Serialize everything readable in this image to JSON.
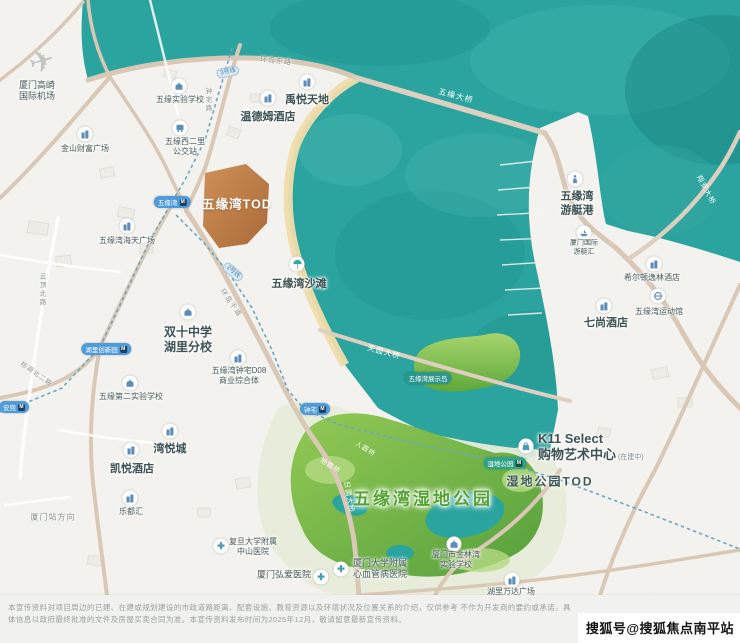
{
  "map": {
    "colors": {
      "water": "#2ba39e",
      "land": "#f3f2ee",
      "road": "#d9c8b5",
      "tod_fill": "#c8834f",
      "wetland_green": "#79bb45",
      "beach": "#f0dcab",
      "metro_dash": "#6aa7c8",
      "station_blue": "#4f9bd8",
      "station_green": "#2fa387"
    },
    "pois": [
      {
        "id": "gaoqi-airport",
        "l": [
          "厦门高崎",
          "国际机场"
        ],
        "x": 37,
        "y": 91,
        "fs": 9,
        "icon": "plane",
        "ix": 42,
        "iy": 62
      },
      {
        "id": "jinshan-plaza",
        "l": [
          "金山财富广场"
        ],
        "x": 85,
        "y": 149,
        "fs": 8,
        "icon": "building",
        "ix": 85,
        "iy": 134
      },
      {
        "id": "wuyuan-exp-school",
        "l": [
          "五缘实验学校"
        ],
        "x": 180,
        "y": 100,
        "fs": 8,
        "icon": "school",
        "ix": 179,
        "iy": 86
      },
      {
        "id": "bus-stop",
        "l": [
          "五缘西二里",
          "公交站"
        ],
        "x": 185,
        "y": 147,
        "fs": 8,
        "icon": "bus",
        "ix": 180,
        "iy": 128
      },
      {
        "id": "yuyue-tiandi",
        "l": [
          "禹悦天地"
        ],
        "x": 307,
        "y": 101,
        "fs": 11,
        "big": true,
        "icon": "building",
        "ix": 307,
        "iy": 82
      },
      {
        "id": "wyndham-hotel",
        "l": [
          "温德姆酒店"
        ],
        "x": 268,
        "y": 118,
        "fs": 11,
        "big": true,
        "icon": "building",
        "ix": 268,
        "iy": 98
      },
      {
        "id": "wuyuan-beach",
        "l": [
          "五缘湾沙滩"
        ],
        "x": 299,
        "y": 285,
        "fs": 11,
        "big": true,
        "icon": "beach",
        "ix": 297,
        "iy": 264
      },
      {
        "id": "shuangshi-school",
        "l": [
          "双十中学",
          "湖里分校"
        ],
        "x": 188,
        "y": 340,
        "fs": 12,
        "big": true,
        "icon": "school",
        "ix": 188,
        "iy": 312
      },
      {
        "id": "d08-complex",
        "l": [
          "五缘湾钟宅D08",
          "商业综合体"
        ],
        "x": 239,
        "y": 376,
        "fs": 8,
        "icon": "building",
        "ix": 238,
        "iy": 358
      },
      {
        "id": "wuyuan-2nd-school",
        "l": [
          "五缘第二实验学校"
        ],
        "x": 131,
        "y": 397,
        "fs": 8,
        "icon": "school",
        "ix": 130,
        "iy": 383
      },
      {
        "id": "haitian-plaza",
        "l": [
          "五缘湾海天广场"
        ],
        "x": 127,
        "y": 241,
        "fs": 8,
        "icon": "building",
        "ix": 127,
        "iy": 226
      },
      {
        "id": "wanyuecheng",
        "l": [
          "湾悦城"
        ],
        "x": 170,
        "y": 450,
        "fs": 11,
        "big": true,
        "icon": "building",
        "ix": 170,
        "iy": 431
      },
      {
        "id": "hyatt-hotel",
        "l": [
          "凯悦酒店"
        ],
        "x": 132,
        "y": 470,
        "fs": 11,
        "big": true,
        "icon": "building",
        "ix": 131,
        "iy": 450
      },
      {
        "id": "leduhui",
        "l": [
          "乐都汇"
        ],
        "x": 131,
        "y": 512,
        "fs": 8,
        "icon": "building",
        "ix": 130,
        "iy": 498
      },
      {
        "id": "zhongshan-hospital",
        "l": [
          "复旦大学附属",
          "中山医院"
        ],
        "x": 253,
        "y": 547,
        "fs": 8,
        "icon": "hospital",
        "ix": 221,
        "iy": 546
      },
      {
        "id": "hongai-hospital",
        "l": [
          "厦门弘爱医院"
        ],
        "x": 284,
        "y": 575,
        "fs": 9,
        "icon": "hospital",
        "ix": 321,
        "iy": 577
      },
      {
        "id": "xinxueguan-hospital",
        "l": [
          "厦门大学附属",
          "心血管病医院"
        ],
        "x": 380,
        "y": 569,
        "fs": 9,
        "icon": "hospital",
        "ix": 341,
        "iy": 569
      },
      {
        "id": "jinlinwan-school",
        "l": [
          "厦门市金林湾",
          "实验学校"
        ],
        "x": 456,
        "y": 560,
        "fs": 8,
        "icon": "school",
        "ix": 454,
        "iy": 544
      },
      {
        "id": "wanda-plaza",
        "l": [
          "湖里万达广场"
        ],
        "x": 511,
        "y": 592,
        "fs": 8,
        "icon": "building",
        "ix": 512,
        "iy": 580
      },
      {
        "id": "yacht-harbor",
        "l": [
          "五缘湾",
          "游艇港"
        ],
        "x": 577,
        "y": 204,
        "fs": 11,
        "big": true,
        "icon": "lighthouse",
        "ix": 575,
        "iy": 179
      },
      {
        "id": "intl-yacht-club",
        "l": [
          "厦门国际",
          "游艇汇"
        ],
        "x": 584,
        "y": 248,
        "fs": 7,
        "icon": "boat",
        "ix": 584,
        "iy": 233
      },
      {
        "id": "hilton-doubletree",
        "l": [
          "希尔顿逸林酒店"
        ],
        "x": 652,
        "y": 278,
        "fs": 8,
        "icon": "building",
        "ix": 654,
        "iy": 264
      },
      {
        "id": "sports-hall",
        "l": [
          "五缘湾运动馆"
        ],
        "x": 659,
        "y": 312,
        "fs": 8,
        "icon": "sport",
        "ix": 658,
        "iy": 296
      },
      {
        "id": "lohkah-hotel",
        "l": [
          "七尚酒店"
        ],
        "x": 606,
        "y": 324,
        "fs": 11,
        "big": true,
        "icon": "building",
        "ix": 604,
        "iy": 306
      },
      {
        "id": "k11-select",
        "l": [
          "K11 Select",
          "购物艺术中心"
        ],
        "suffix": "(在建中)",
        "x": 538,
        "y": 447,
        "fs": 13,
        "big": true,
        "align": "left",
        "icon": "bag",
        "ix": 526,
        "iy": 446
      }
    ],
    "road_labels": [
      {
        "t": "环岛东路",
        "x": 276,
        "y": 61,
        "rot": 6,
        "fs": 7,
        "c": "gray"
      },
      {
        "t": "五缘大桥",
        "x": 456,
        "y": 96,
        "rot": 15,
        "fs": 8,
        "c": "white"
      },
      {
        "t": "钟宅路",
        "x": 207,
        "y": 100,
        "fs": 6.5,
        "c": "gray",
        "vert": true
      },
      {
        "t": "环岛干道",
        "x": 231,
        "y": 303,
        "rot": 55,
        "fs": 7,
        "c": "gray"
      },
      {
        "t": "云顶北路",
        "x": 41,
        "y": 290,
        "fs": 6.5,
        "c": "gray",
        "vert": true
      },
      {
        "t": "枋湖北二路",
        "x": 37,
        "y": 373,
        "rot": 35,
        "fs": 6.5,
        "c": "gray"
      },
      {
        "t": "天圆大桥",
        "x": 384,
        "y": 352,
        "rot": 15,
        "fs": 7.5,
        "c": "white"
      },
      {
        "t": "日圆大桥",
        "x": 349,
        "y": 497,
        "rot": 80,
        "fs": 7,
        "c": "white"
      },
      {
        "t": "人圆桥",
        "x": 366,
        "y": 448,
        "rot": 32,
        "fs": 6.5,
        "c": "white"
      },
      {
        "t": "地圆桥",
        "x": 331,
        "y": 465,
        "rot": 32,
        "fs": 6.5,
        "c": "white"
      },
      {
        "t": "翔安大桥",
        "x": 706,
        "y": 190,
        "rot": 62,
        "fs": 7,
        "c": "white"
      },
      {
        "t": "厦门站方向",
        "x": 53,
        "y": 517,
        "rot": 0,
        "fs": 8,
        "c": "gray"
      }
    ],
    "stations": [
      {
        "t": "五缘湾",
        "x": 172,
        "y": 202,
        "c": "blue"
      },
      {
        "t": "湖里创新园",
        "x": 106,
        "y": 349,
        "c": "blue"
      },
      {
        "t": "钟宅",
        "x": 315,
        "y": 409,
        "c": "blue"
      },
      {
        "t": "安兜",
        "x": 14,
        "y": 407,
        "c": "blue"
      },
      {
        "t": "湿地公园",
        "x": 505,
        "y": 463,
        "c": "green"
      },
      {
        "t": "五缘湾展示岛",
        "x": 428,
        "y": 378,
        "c": "teal",
        "noicon": true
      }
    ],
    "badges": [
      {
        "t": "3号线",
        "x": 228,
        "y": 72,
        "rot": -12
      },
      {
        "t": "2号线",
        "x": 233,
        "y": 272,
        "rot": 40
      }
    ],
    "area_labels": [
      {
        "id": "wuyuanwan-tod",
        "t": "五缘湾TOD",
        "x": 237,
        "y": 203,
        "fs": 12.5,
        "cls": "area-tod"
      },
      {
        "id": "wetland-park",
        "t": "五缘湾湿地公园",
        "x": 423,
        "y": 497,
        "fs": 17,
        "cls": "area-wetland"
      },
      {
        "id": "shidi-tod",
        "t": "湿地公园TOD",
        "x": 550,
        "y": 481,
        "fs": 12,
        "cls": "area-plain"
      }
    ]
  },
  "footer": {
    "disclaimer_line1": "本宣传资料对项目周边的已建、在建或规划建设的市政道路距离、配套设施、教育资源以及环境状况及位置关系的介绍，仅供参考 不作为开发商的要约或承诺，具",
    "disclaimer_line2": "体信息以政府最终批准的文件及房屋买卖合同为准。本宣传资料发布时间为2025年12月，敬请留意最新宣传资料。"
  },
  "watermark": {
    "text": "搜狐号@搜狐焦点南平站"
  }
}
